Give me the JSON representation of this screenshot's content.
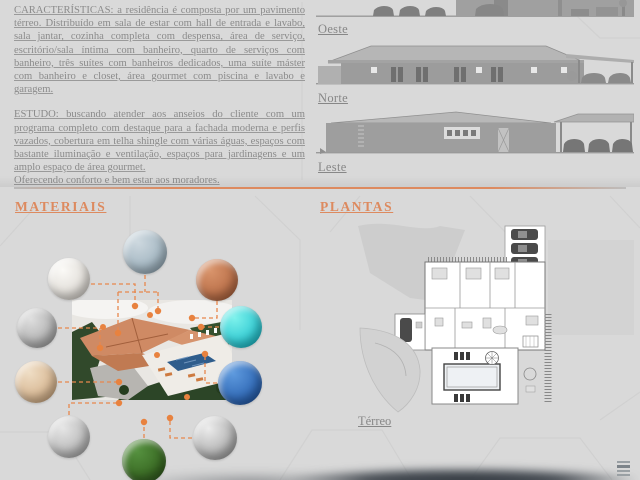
{
  "colors": {
    "background": "#d9d9d9",
    "accent_orange": "#dd8a5f",
    "callout_orange": "#e8874d",
    "body_text": "#8b8b8b",
    "label_text": "#878787",
    "roof_terracotta": "#cf8a64",
    "pool_blue": "#2f5d8c",
    "bottom_shadow": "#3c4249"
  },
  "description": {
    "caracteristicas": "CARACTERÍSTICAS: a residência é composta por um pavimento térreo. Distribuído em sala de estar com hall de entrada e lavabo, sala jantar, cozinha completa com despensa, área de serviço, escritório/sala íntima com banheiro, quarto de serviços com banheiro, três suítes com banheiros dedicados, uma suíte máster com banheiro e closet, área gourmet com piscina e lavabo e garagem.",
    "estudo": "ESTUDO: buscando atender aos anseios do cliente com um programa completo com destaque para a fachada moderna e perfis vazados, cobertura em telha shingle com várias águas, espaços com bastante iluminação e ventilação, espaços para jardinagens e um amplo espaço de área gourmet.",
    "estudo_final": "Oferecendo conforto e bem estar aos moradores."
  },
  "elevations": [
    {
      "label": "Oeste"
    },
    {
      "label": "Norte"
    },
    {
      "label": "Leste"
    }
  ],
  "materials": {
    "title": "MATERIAIS",
    "swatches": [
      {
        "name": "white-marble",
        "color1": "#fbfaf7",
        "color2": "#dcd8d2",
        "color3": "#bdb9b2"
      },
      {
        "name": "speckled-blue-stone",
        "color1": "#cdd8df",
        "color2": "#9db1bd",
        "color3": "#7e95a3"
      },
      {
        "name": "copper-shingles",
        "color1": "#d9946b",
        "color2": "#b56a44",
        "color3": "#8d4c2e"
      },
      {
        "name": "gray-granite",
        "color1": "#dedede",
        "color2": "#ababab",
        "color3": "#8c8c8c"
      },
      {
        "name": "turquoise-water",
        "color1": "#7df2ec",
        "color2": "#27c4cf",
        "color3": "#0f9bb0"
      },
      {
        "name": "beige-travertine",
        "color1": "#efddc4",
        "color2": "#d4b28c",
        "color3": "#b8926b"
      },
      {
        "name": "blue-pool-tile",
        "color1": "#5e9ade",
        "color2": "#2a62b0",
        "color3": "#1c4886"
      },
      {
        "name": "stone-pavers",
        "color1": "#e6e6e6",
        "color2": "#b3b3b3",
        "color3": "#949494"
      },
      {
        "name": "green-grass",
        "color1": "#55913f",
        "color2": "#35631f",
        "color3": "#254a16"
      },
      {
        "name": "brushed-metal",
        "color1": "#ececec",
        "color2": "#a9a9a9",
        "color3": "#8f8f8f"
      }
    ]
  },
  "plans": {
    "title": "PLANTAS",
    "floor_label": "Térreo"
  }
}
